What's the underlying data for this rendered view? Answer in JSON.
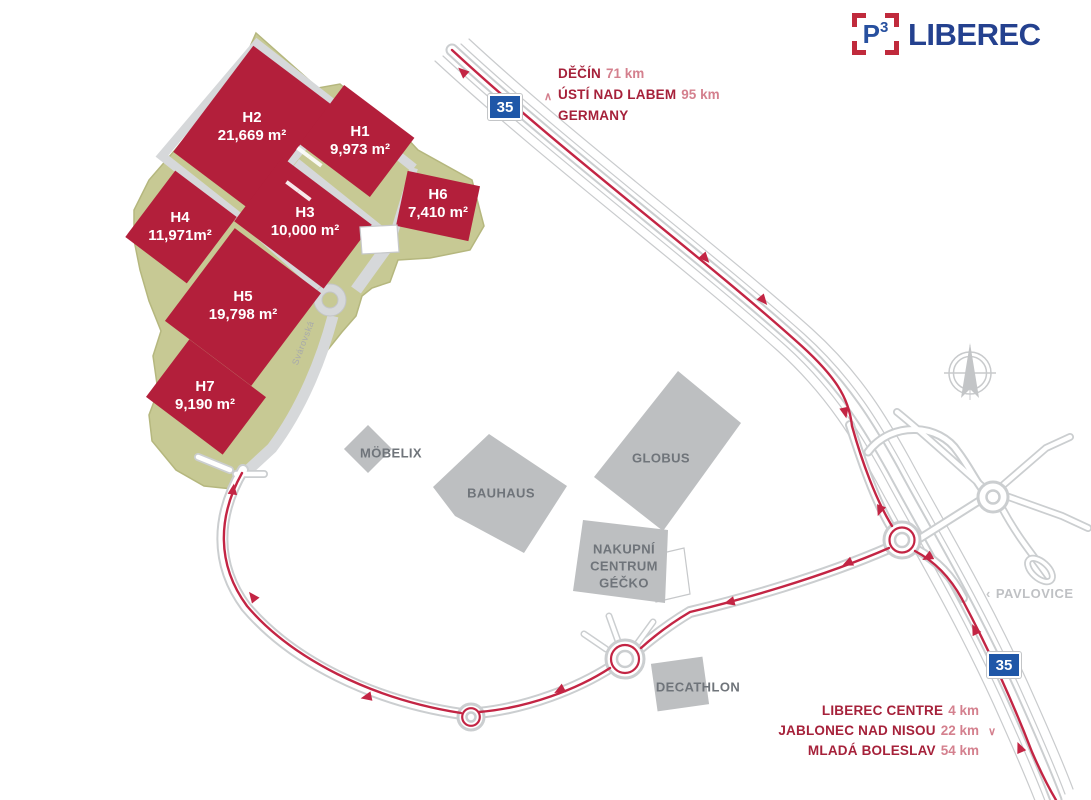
{
  "logo": {
    "p": "P",
    "sup": "3",
    "name": "LIBEREC"
  },
  "signs": {
    "route_number": "35"
  },
  "park": {
    "street": "Svárovská",
    "buildings": [
      {
        "id": "H1",
        "area": "9,973 m²"
      },
      {
        "id": "H2",
        "area": "21,669 m²"
      },
      {
        "id": "H3",
        "area": "10,000 m²"
      },
      {
        "id": "H4",
        "area": "11,971m²"
      },
      {
        "id": "H5",
        "area": "19,798 m²"
      },
      {
        "id": "H6",
        "area": "7,410 m²"
      },
      {
        "id": "H7",
        "area": "9,190 m²"
      }
    ]
  },
  "destinations": {
    "north": [
      {
        "chevron": "",
        "name": "DĚČÍN",
        "distance": "71 km"
      },
      {
        "chevron": "∧",
        "name": "ÚSTÍ NAD LABEM",
        "distance": "95 km"
      },
      {
        "chevron": "",
        "name": "GERMANY",
        "distance": ""
      }
    ],
    "south": [
      {
        "chevron": "",
        "name": "LIBEREC CENTRE",
        "distance": "4 km"
      },
      {
        "chevron": "∨",
        "name": "JABLONEC NAD NISOU",
        "distance": "22 km"
      },
      {
        "chevron": "",
        "name": "MLADÁ BOLESLAV",
        "distance": "54 km"
      }
    ]
  },
  "places": {
    "pavlovice_chevron": "‹",
    "pavlovice": "PAVLOVICE"
  },
  "pois": {
    "mobelix": "MÖBELIX",
    "bauhaus": "BAUHAUS",
    "globus": "GLOBUS",
    "gecko_lines": [
      "NAKUPNÍ",
      "CENTRUM",
      "GÉČKO"
    ],
    "decathlon": "DECATHLON"
  },
  "colors": {
    "building_red": "#b31f3b",
    "route_red": "#c32544",
    "site_green": "#c7c994",
    "retail_gray": "#bdbfc1",
    "road_gray": "#cbced0",
    "label_gray": "#6f747a",
    "sign_blue": "#1f57a8",
    "logo_blue": "#27509f",
    "logo_bracket_red": "#c02a3c",
    "destination_red": "#a6213a",
    "destination_light_red": "#d4808e"
  }
}
